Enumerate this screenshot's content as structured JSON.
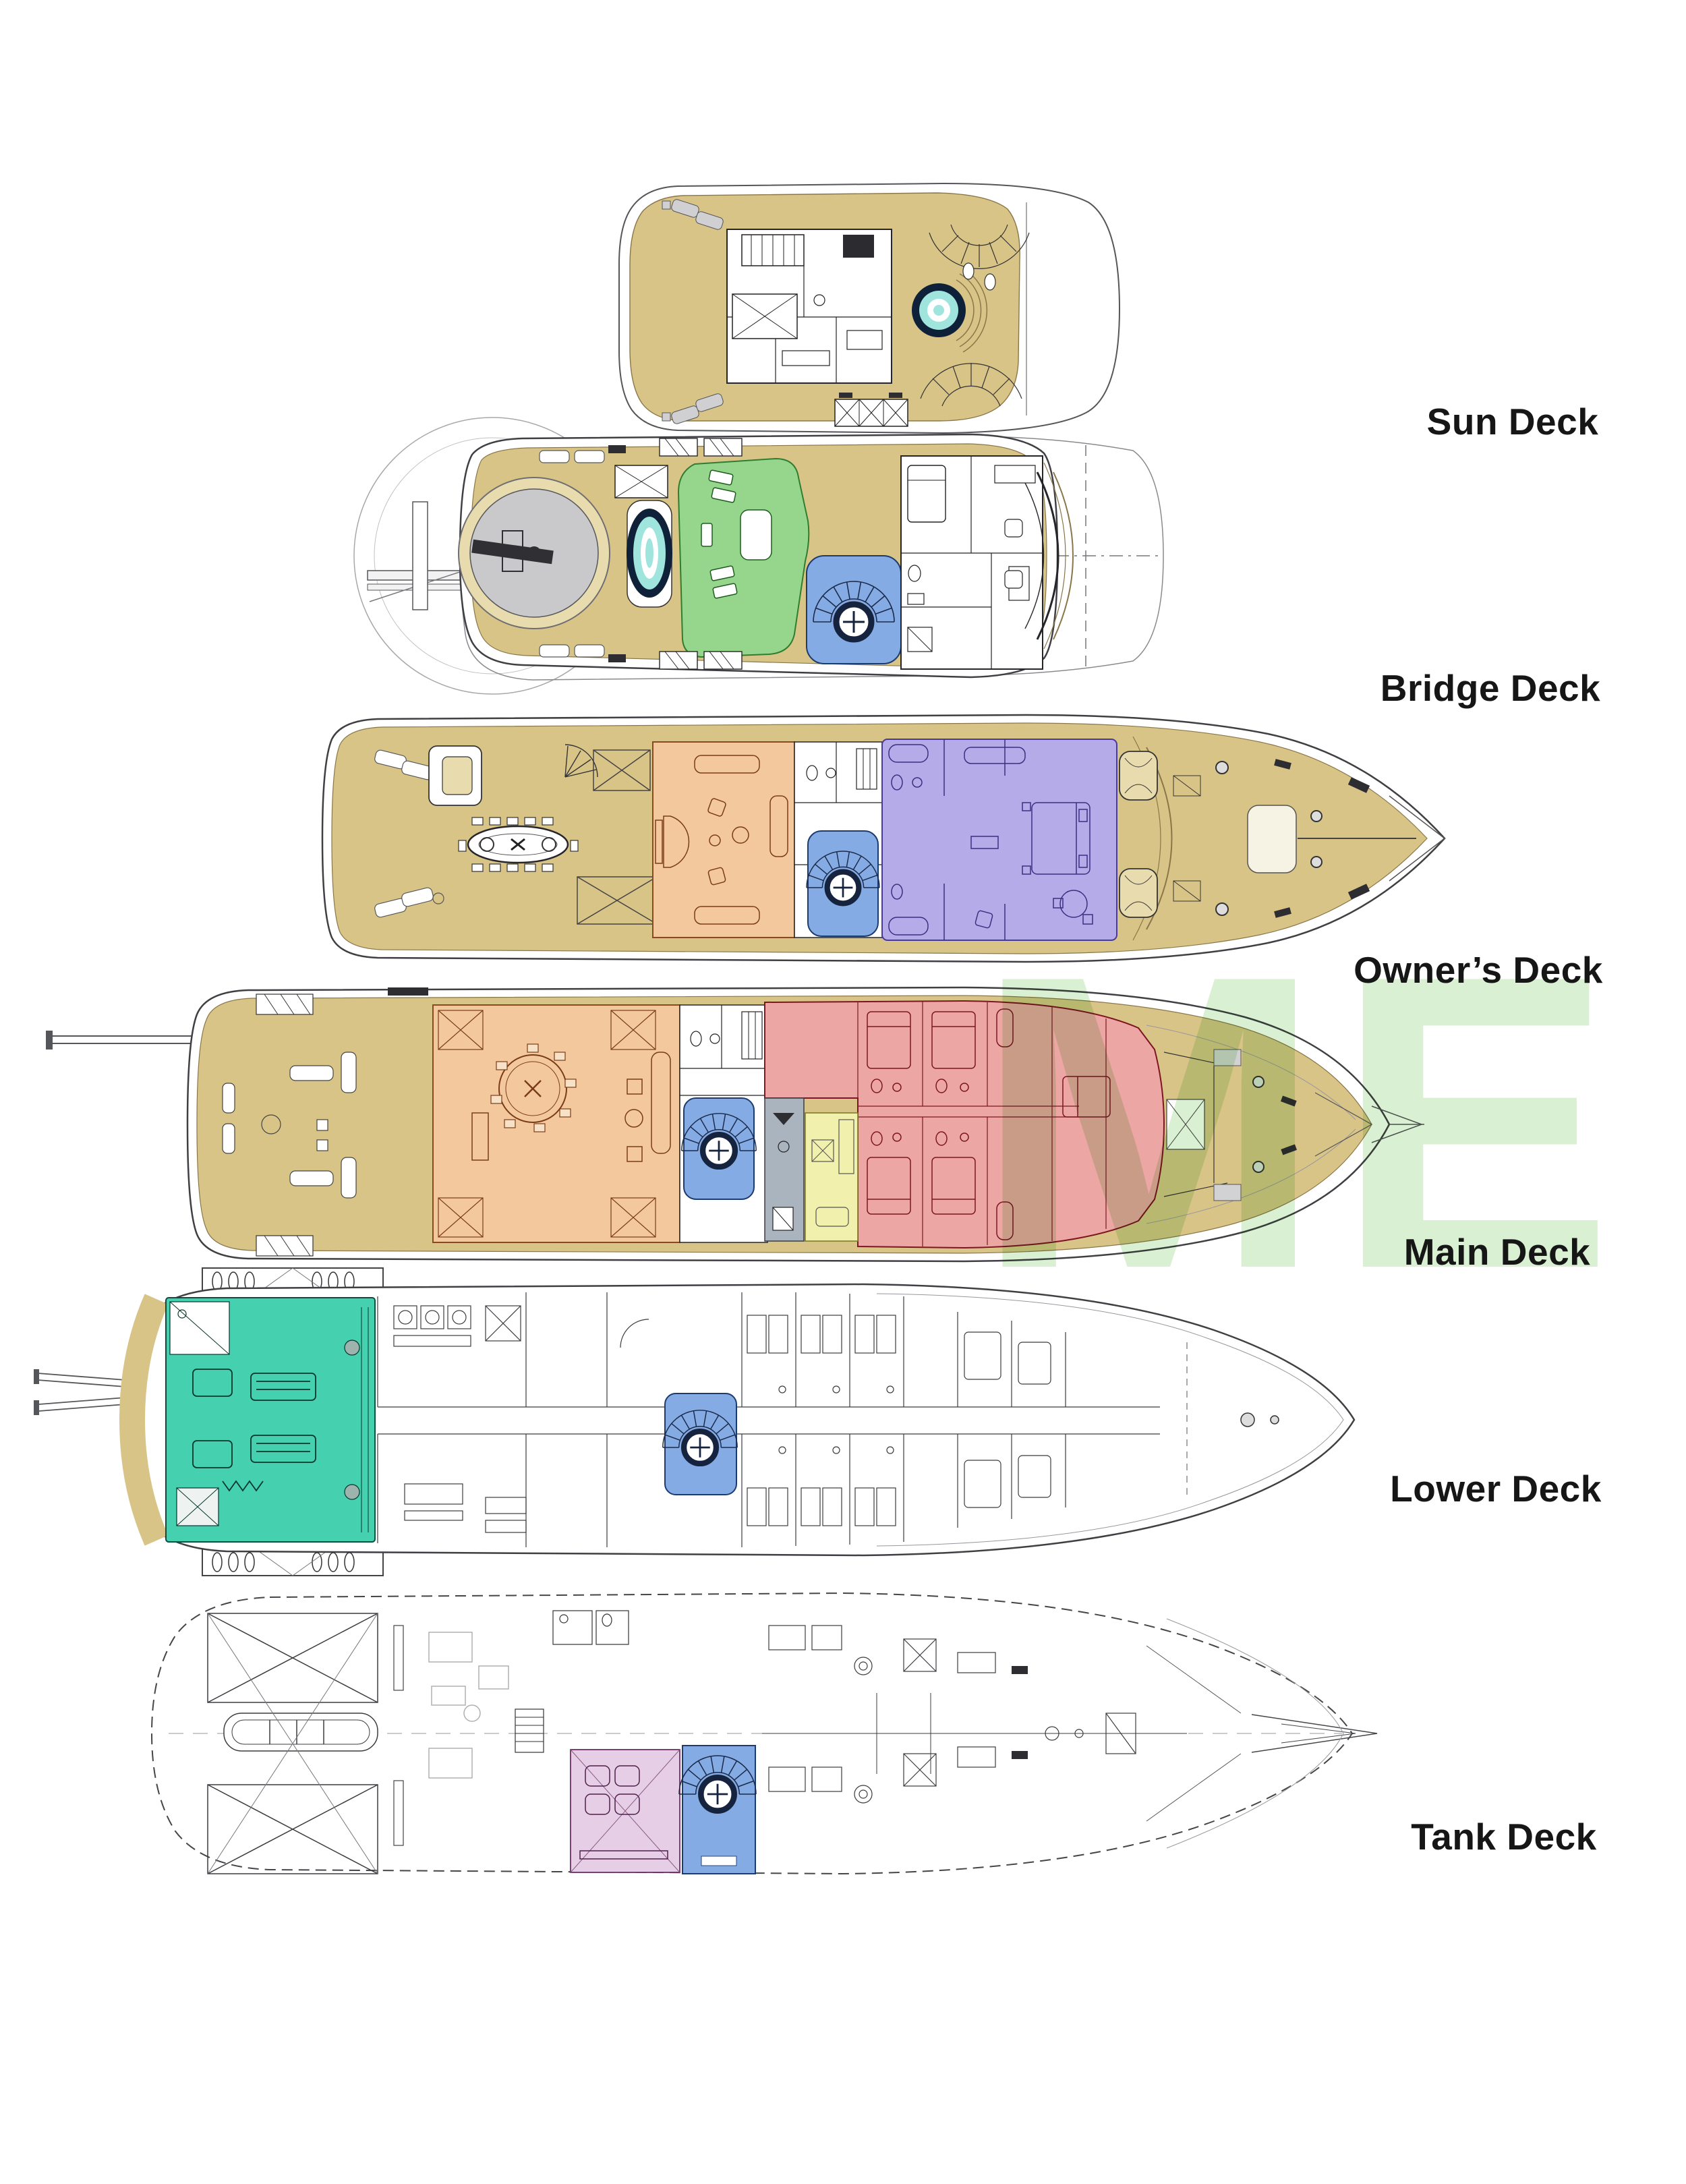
{
  "page": {
    "background": "#ffffff"
  },
  "watermark": {
    "text": "ME",
    "color": "#d9f0d2"
  },
  "decks": [
    {
      "id": "sun-deck",
      "label": "Sun Deck"
    },
    {
      "id": "bridge-deck",
      "label": "Bridge Deck"
    },
    {
      "id": "owners-deck",
      "label": "Owner’s Deck"
    },
    {
      "id": "main-deck",
      "label": "Main Deck"
    },
    {
      "id": "lower-deck",
      "label": "Lower Deck"
    },
    {
      "id": "tank-deck",
      "label": "Tank Deck"
    }
  ],
  "colors": {
    "teak": "#d9c488",
    "teak_light": "#e8dcae",
    "cyan_pool": "#9fe5de",
    "green_room": "#95d68c",
    "blue_stair": "#84abe4",
    "orange_room": "#f3c89d",
    "purple_room": "#b5abe8",
    "red_room": "#eca6a4",
    "yellow_room": "#f1f1ad",
    "teal_room": "#45d0b0",
    "pink_room": "#e6cfe6",
    "gray_room": "#a9b4bf",
    "label_text": "#161616"
  }
}
